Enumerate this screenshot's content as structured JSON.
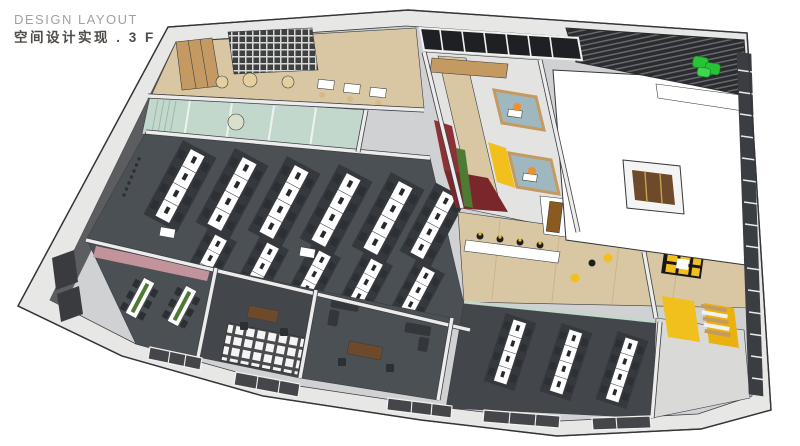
{
  "header": {
    "title": "DESIGN LAYOUT",
    "subtitle": "空间设计实现 . 3 F"
  },
  "colors": {
    "wall": "#e7e7e6",
    "wall-top": "#f8f8f8",
    "base": "#cfd1d2",
    "inner-wall": "#5c5d60",
    "carpet": "#4b5055",
    "carpet-dark": "#35393d",
    "carpet2": "#43474c",
    "chair": "#2c2f33",
    "wood": "#d9c7a4",
    "wood-mid": "#c49a62",
    "wood-dark": "#6e4a2a",
    "teal-glass": "#c2d8cc",
    "teal-mullion": "#edf4f0",
    "red-wall": "#8e3136",
    "red-floor": "#7a272b",
    "plant": "#4e7a34",
    "green-sofa": "#29c337",
    "yellow": "#f2c01d",
    "mauve": "#c2939b",
    "louver": "#2b2c30",
    "orange": "#f08f2e",
    "glass-blue": "#9fb8c0",
    "beige": "#ead9b8",
    "art-frame": "#8a5a1e",
    "facade": "#3a3d42",
    "white-roof": "#ffffff"
  }
}
